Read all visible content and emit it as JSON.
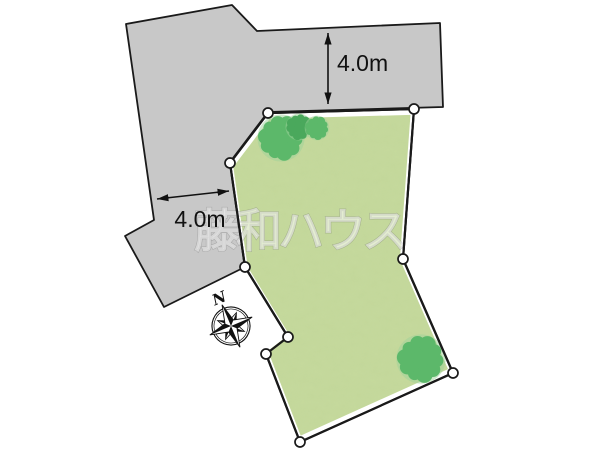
{
  "labels": {
    "dimension_top": "4.0m",
    "dimension_left": "4.0m",
    "compass_north": "N",
    "watermark": "藤和ハウス"
  },
  "colors": {
    "background": "#ffffff",
    "road": "#c8c8c8",
    "outline": "#1a1a1a",
    "parcel_fill": "#c6da9d",
    "parcel_border": "#ffffff",
    "vertex_fill": "#ffffff",
    "tree": "#5cb86a",
    "tree_dark": "#4aa85c",
    "tree_halo": "#9ed29a",
    "dimension": "#111111"
  },
  "geometry": {
    "road_polygon": [
      [
        126,
        24
      ],
      [
        232,
        5
      ],
      [
        257,
        31
      ],
      [
        440,
        23
      ],
      [
        443,
        107
      ],
      [
        268,
        112
      ],
      [
        230,
        162
      ],
      [
        245,
        267
      ],
      [
        164,
        307
      ],
      [
        125,
        236
      ],
      [
        154,
        220
      ]
    ],
    "parcel_polygon": [
      [
        230,
        163
      ],
      [
        268,
        113
      ],
      [
        414,
        109
      ],
      [
        403,
        259
      ],
      [
        453,
        373
      ],
      [
        300,
        442
      ],
      [
        266,
        354
      ],
      [
        288,
        337
      ],
      [
        245,
        267
      ]
    ],
    "parcel_inner_scale": 0.963,
    "vertex_radius": 5,
    "trees": [
      {
        "cx": 281,
        "cy": 138,
        "r": 21,
        "shade": "tree"
      },
      {
        "cx": 299,
        "cy": 127,
        "r": 12,
        "shade": "tree_dark"
      },
      {
        "cx": 317,
        "cy": 128,
        "r": 11,
        "shade": "tree"
      },
      {
        "cx": 421,
        "cy": 359,
        "r": 22,
        "shade": "tree"
      }
    ],
    "dimension_top": {
      "x1": 328,
      "y1": 33,
      "x2": 328,
      "y2": 104,
      "label_x": 337,
      "label_y": 71,
      "label_anchor": "start"
    },
    "dimension_left": {
      "x1": 157,
      "y1": 199,
      "x2": 229,
      "y2": 191,
      "label_x": 200,
      "label_y": 227,
      "label_anchor": "middle"
    },
    "compass": {
      "cx": 231,
      "cy": 326,
      "rotation": -23
    },
    "watermark": {
      "x": 299,
      "y": 247,
      "font_size": 46
    }
  }
}
